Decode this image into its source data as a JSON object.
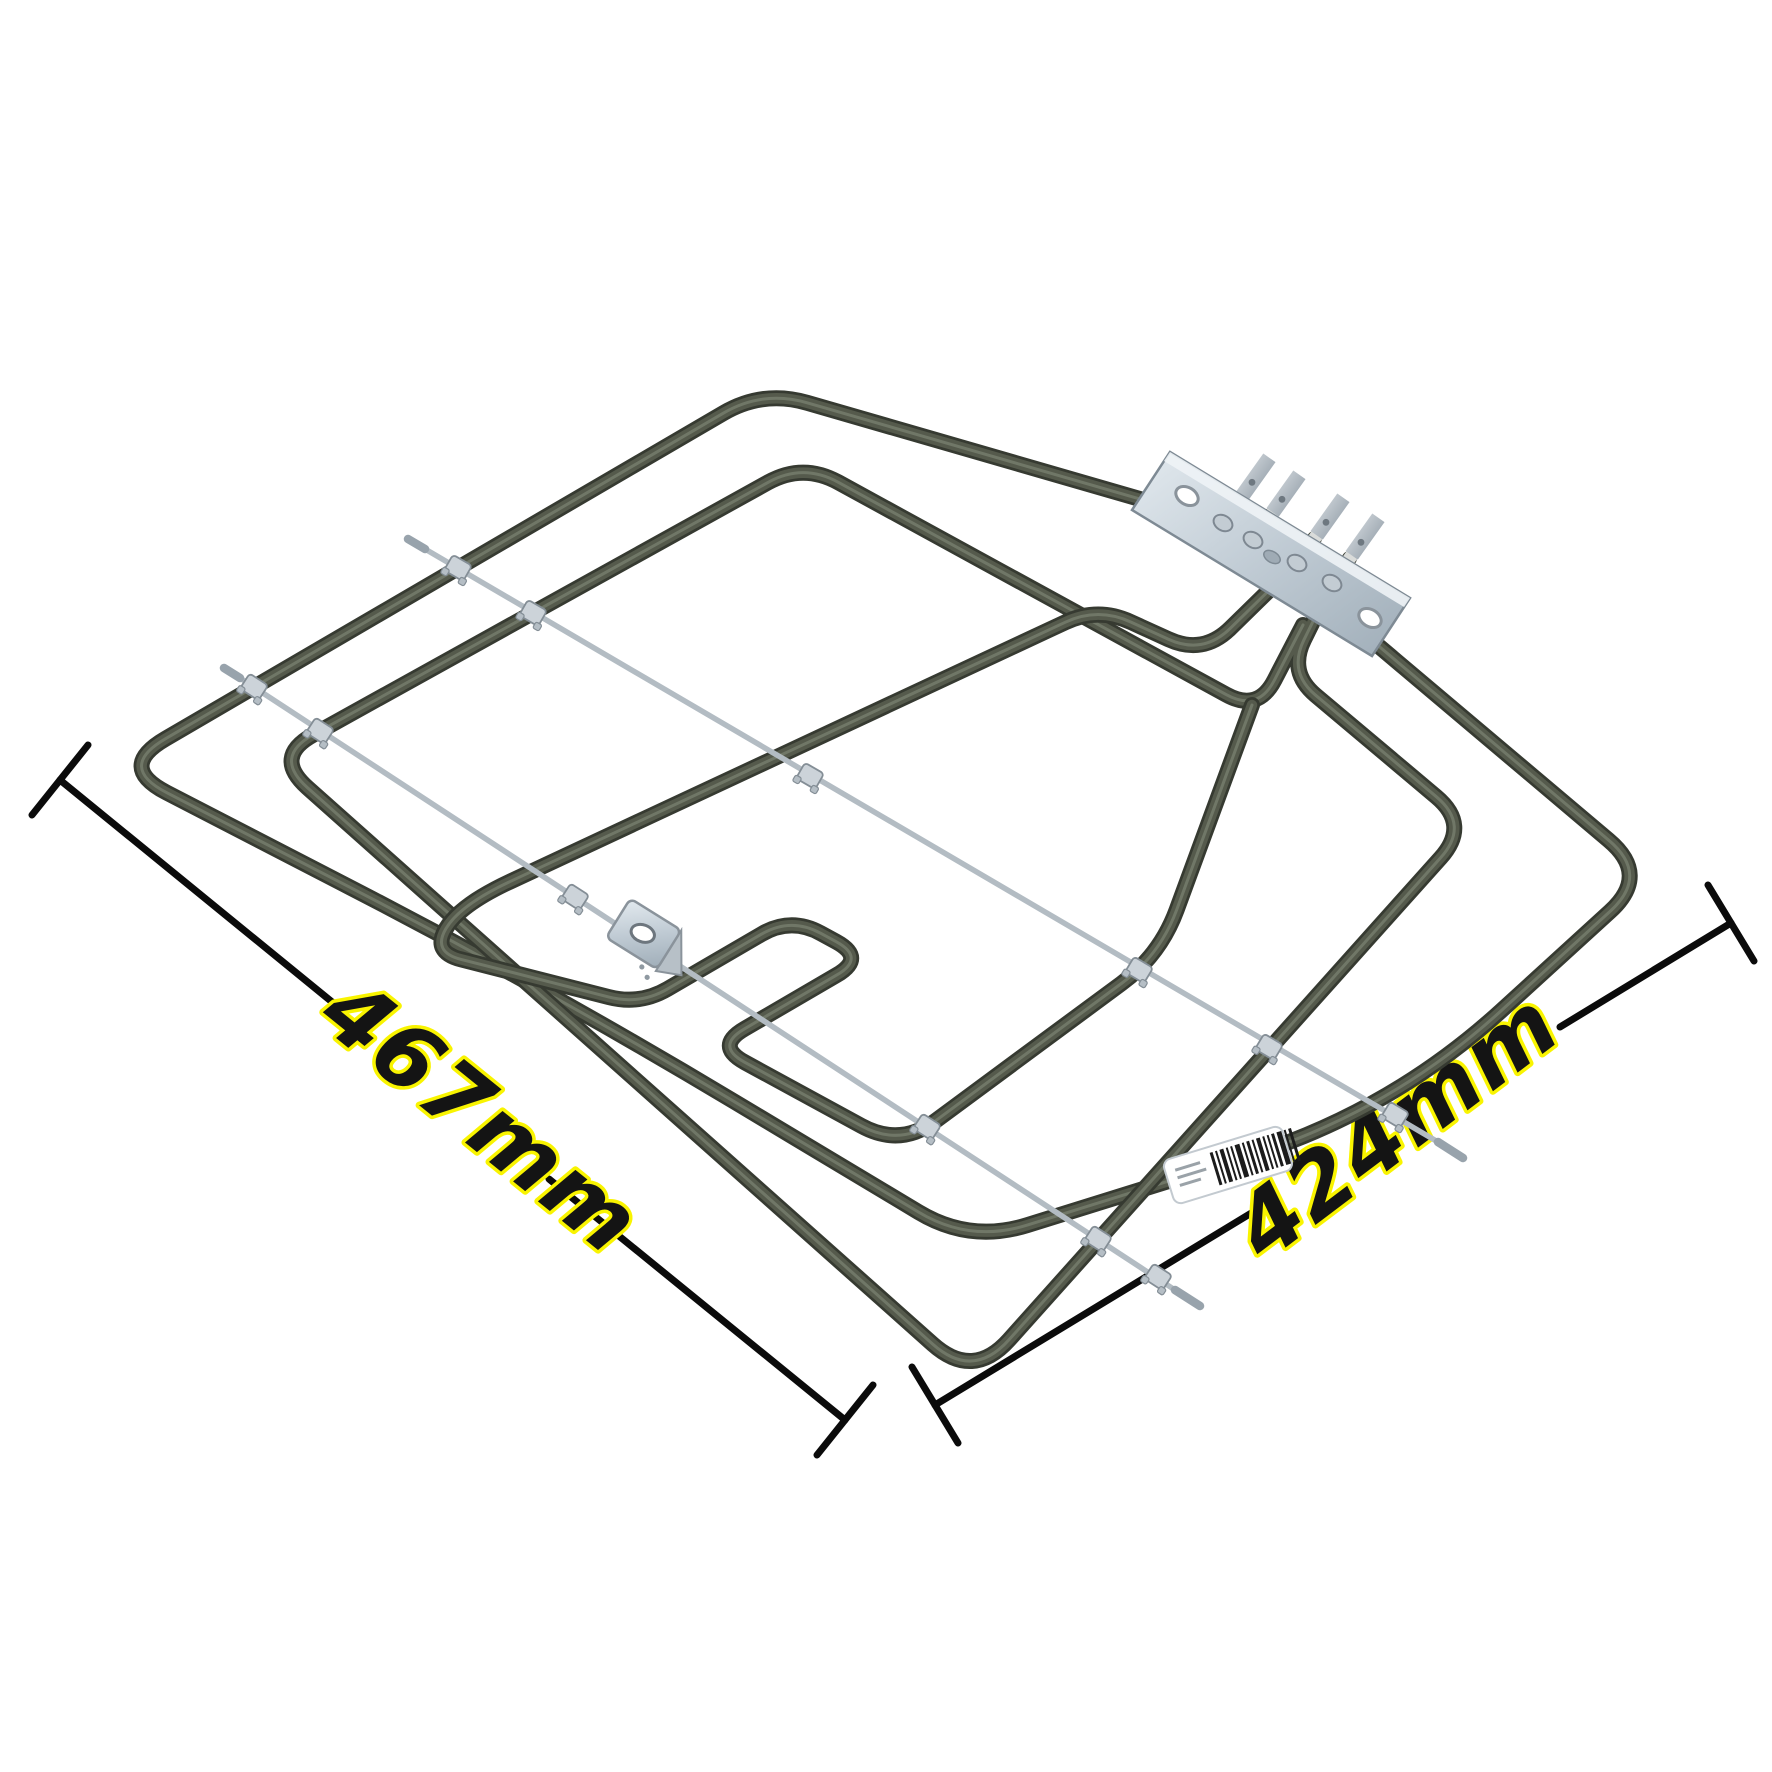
{
  "image": {
    "description": "Product photo of a dual grill/oven heating element viewed at an angle on a white background",
    "background_color": "#ffffff"
  },
  "dimensions": {
    "width_label": "467mm",
    "depth_label": "424mm"
  },
  "colors": {
    "tube_outline": "#363a31",
    "tube_body": "#555a4c",
    "tube_sheen": "#767c6c",
    "support_rod": "#b3bcc3",
    "clip_metal": "#ccd3d9",
    "plate_metal_light": "#dce3e9",
    "plate_metal_dark": "#a9b5bf",
    "dimension_line": "#0b0b0b",
    "label_fill": "#141414",
    "label_outline": "#f9f400",
    "barcode_label_bg": "#ffffff",
    "barcode_stripes": "#1c1c1c"
  }
}
